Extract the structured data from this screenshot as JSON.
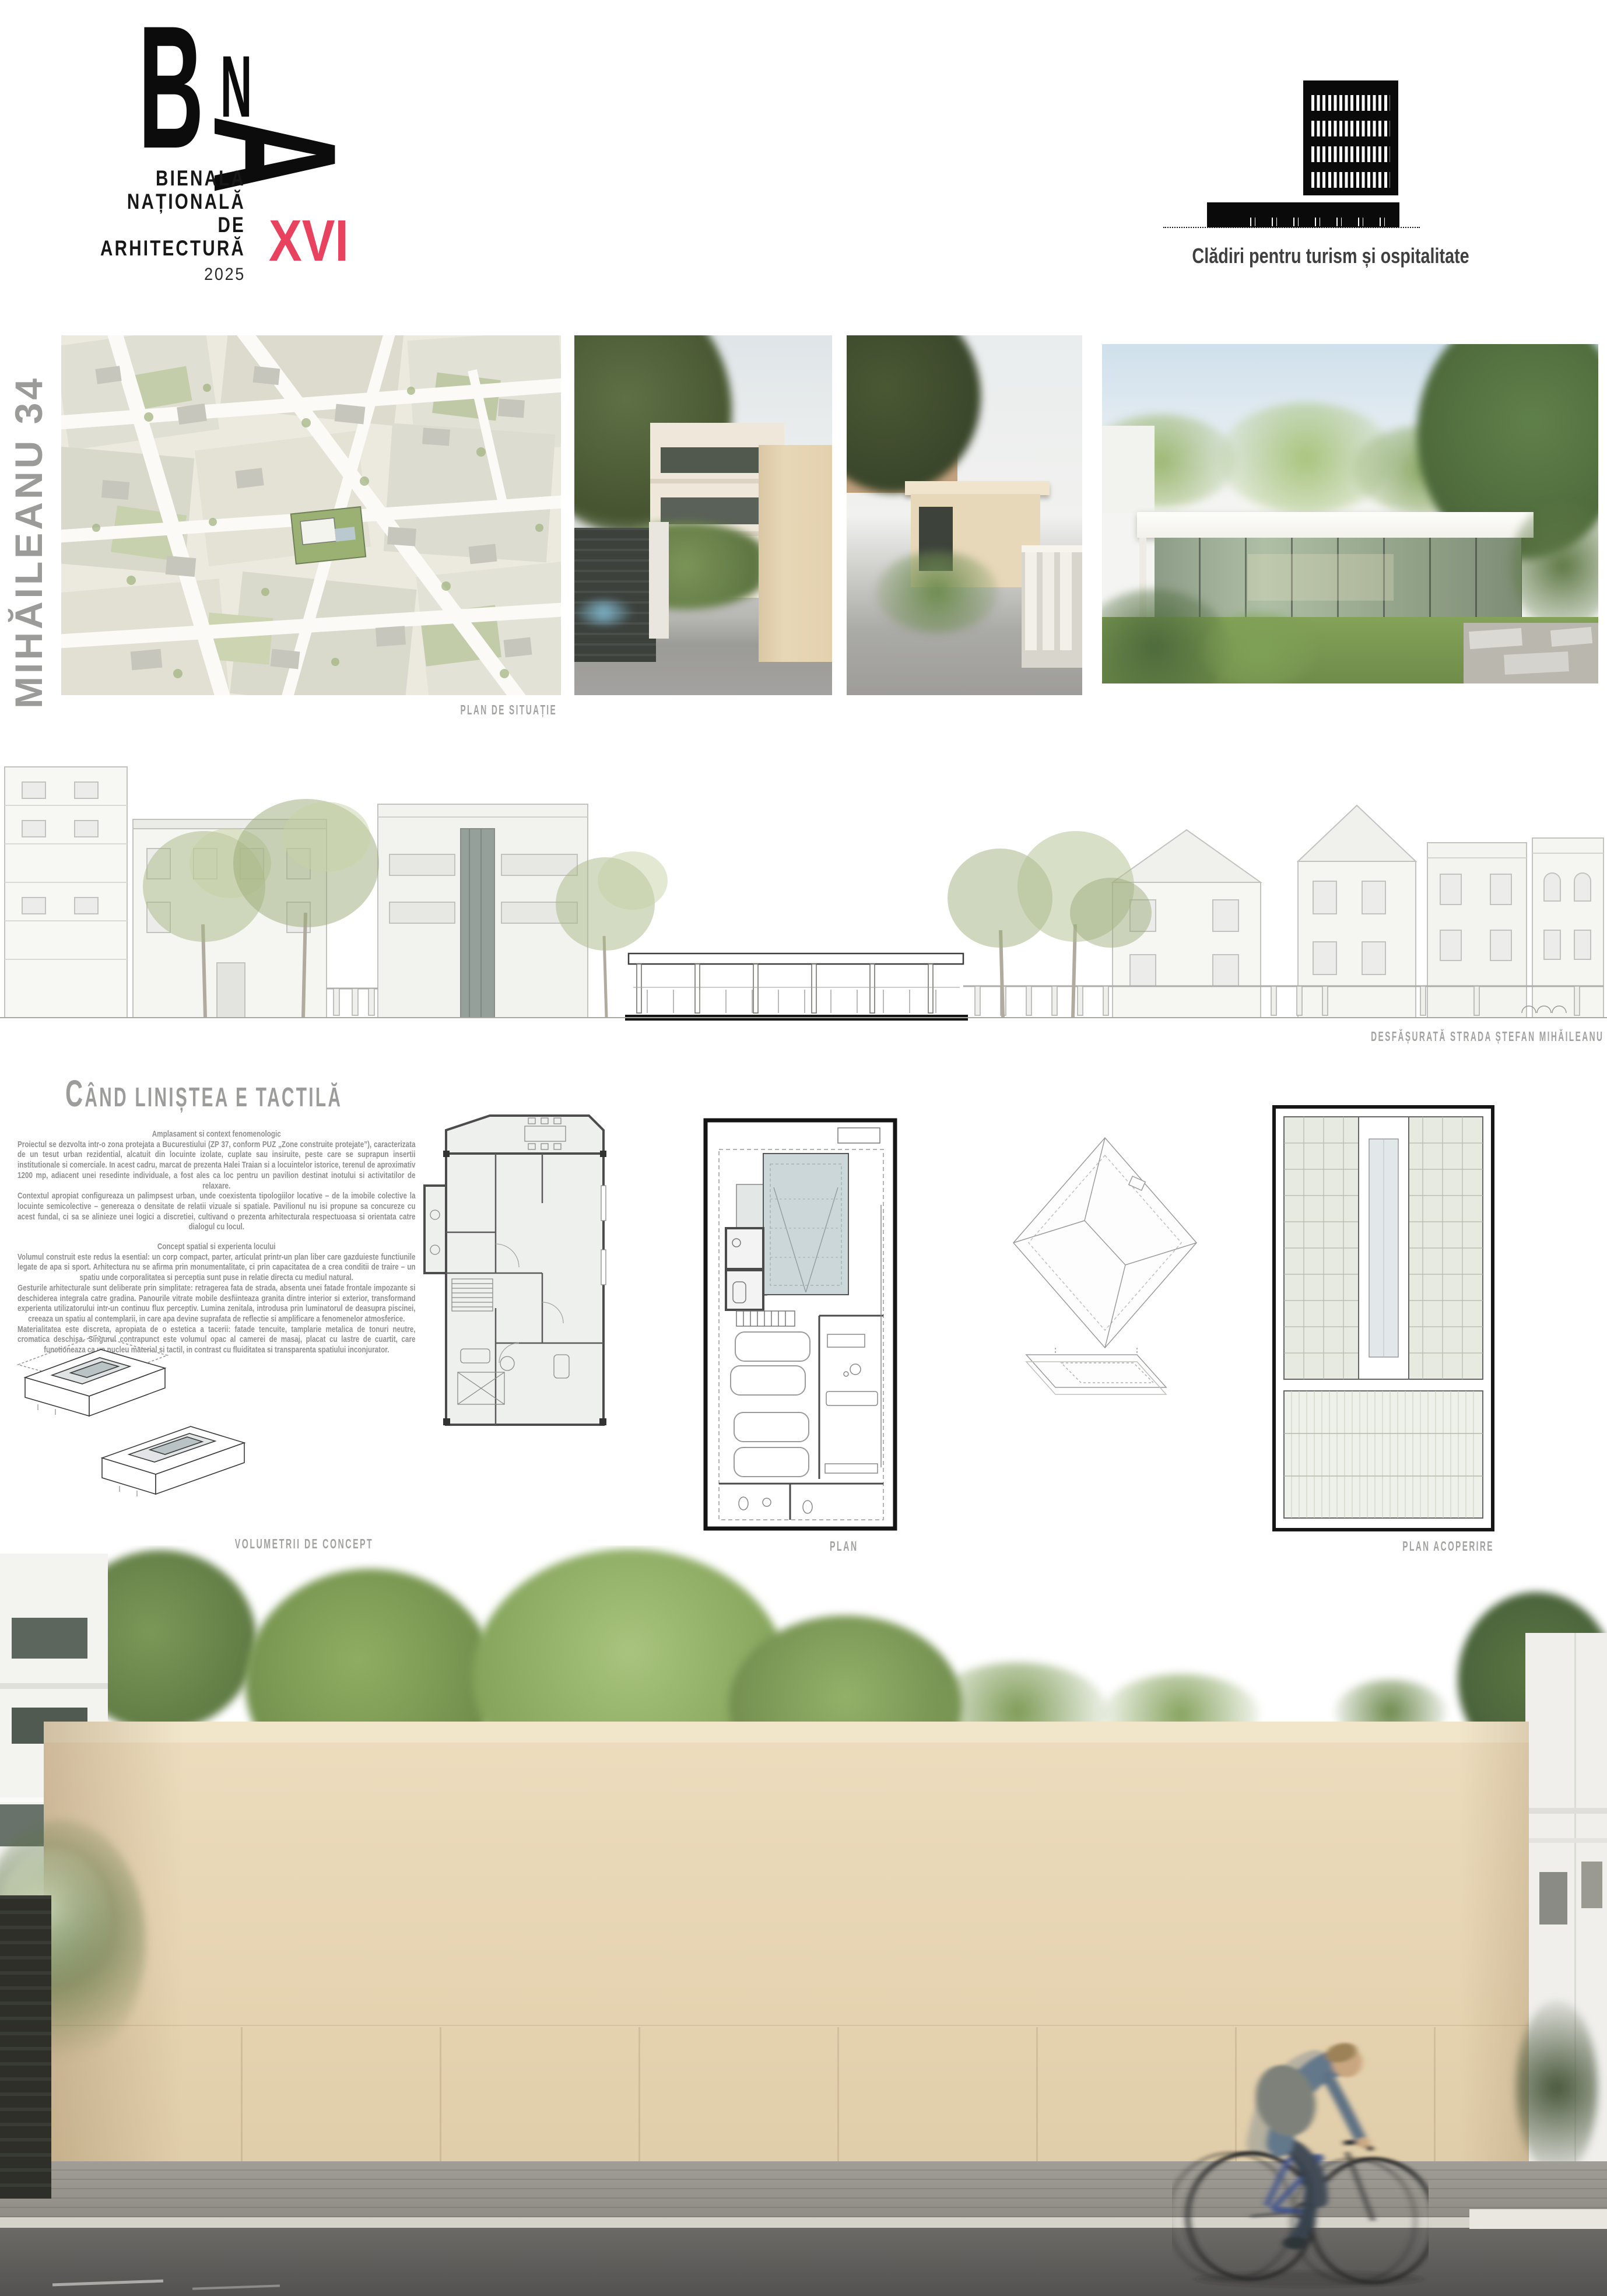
{
  "board": {
    "project_title_vertical": "MIHĂILEANU 34",
    "logo": {
      "letter_b": "B",
      "letter_n": "N",
      "letter_a": "A",
      "line1": "BIENALA",
      "line2": "NAȚIONALĂ",
      "line3": "DE",
      "line4": "ARHITECTURĂ",
      "edition": "XVI",
      "year": "2025"
    },
    "category": {
      "label": "Clădiri pentru turism și ospitalitate"
    },
    "captions": {
      "site_plan": "PLAN DE SITUAȚIE",
      "elevation": "DESFĂȘURATĂ STRADA ȘTEFAN MIHĂILEANU",
      "concept": "VOLUMETRII DE CONCEPT",
      "plan": "PLAN",
      "roof_plan": "PLAN ACOPERIRE"
    },
    "article": {
      "title": "CÂND LINIȘTEA E TACTILĂ",
      "heading1": "Amplasament si context fenomenologic",
      "p1": "Proiectul se dezvolta intr-o zona protejata a Bucurestiului (ZP 37, conform PUZ „Zone construite protejate”), caracterizata de un tesut urban rezidential, alcatuit din locuinte izolate, cuplate sau insiruite, peste care se suprapun insertii institutionale si comerciale. In acest cadru, marcat de prezenta Halei Traian si a locuintelor istorice, terenul de aproximativ 1200 mp, adiacent unei resedinte individuale, a fost ales ca loc pentru un pavilion destinat inotului si activitatilor de relaxare.",
      "p2": "Contextul apropiat configureaza un palimpsest urban, unde coexistenta tipologiilor locative – de la imobile colective la locuinte semicolective – genereaza o densitate de relatii vizuale si spatiale. Pavilionul nu isi propune sa concureze cu acest fundal, ci sa se alinieze unei logici a discretiei, cultivand o prezenta arhitecturala respectuoasa si orientata catre dialogul cu locul.",
      "heading2": "Concept spatial si experienta locului",
      "p3": "Volumul construit este redus la esential: un corp compact, parter, articulat printr-un plan liber care gazduieste functiunile legate de apa si sport. Arhitectura nu se afirma prin monumentalitate, ci prin capacitatea de a crea conditii de traire – un spatiu unde corporalitatea si perceptia sunt puse in relatie directa cu mediul natural.",
      "p4": "Gesturile arhitecturale sunt deliberate prin simplitate: retragerea fata de strada, absenta unei fatade frontale impozante si deschiderea integrala catre gradina. Panourile vitrate mobile desfiinteaza granita dintre interior si exterior, transformand experienta utilizatorului intr-un continuu flux perceptiv. Lumina zenitala, introdusa prin luminatorul de deasupra piscinei, creeaza un spatiu al contemplarii, in care apa devine suprafata de reflectie si amplificare a fenomenelor atmosferice.",
      "p5": "Materialitatea este discreta, apropiata de o estetica a tacerii: fatade tencuite, tamplarie metalica de tonuri neutre, cromatica deschisa. Singurul contrapunct este volumul opac al camerei de masaj, placat cu lastre de cuartit, care functioneaza ca un nucleu material si tactil, in contrast cu fluiditatea si transparenta spatiului inconjurator."
    },
    "colors": {
      "accent_pink": "#E8425F",
      "caption_gray": "#9D9D9C",
      "text_gray": "#8F8F8F",
      "facade_beige": "#E8D8B8"
    }
  }
}
